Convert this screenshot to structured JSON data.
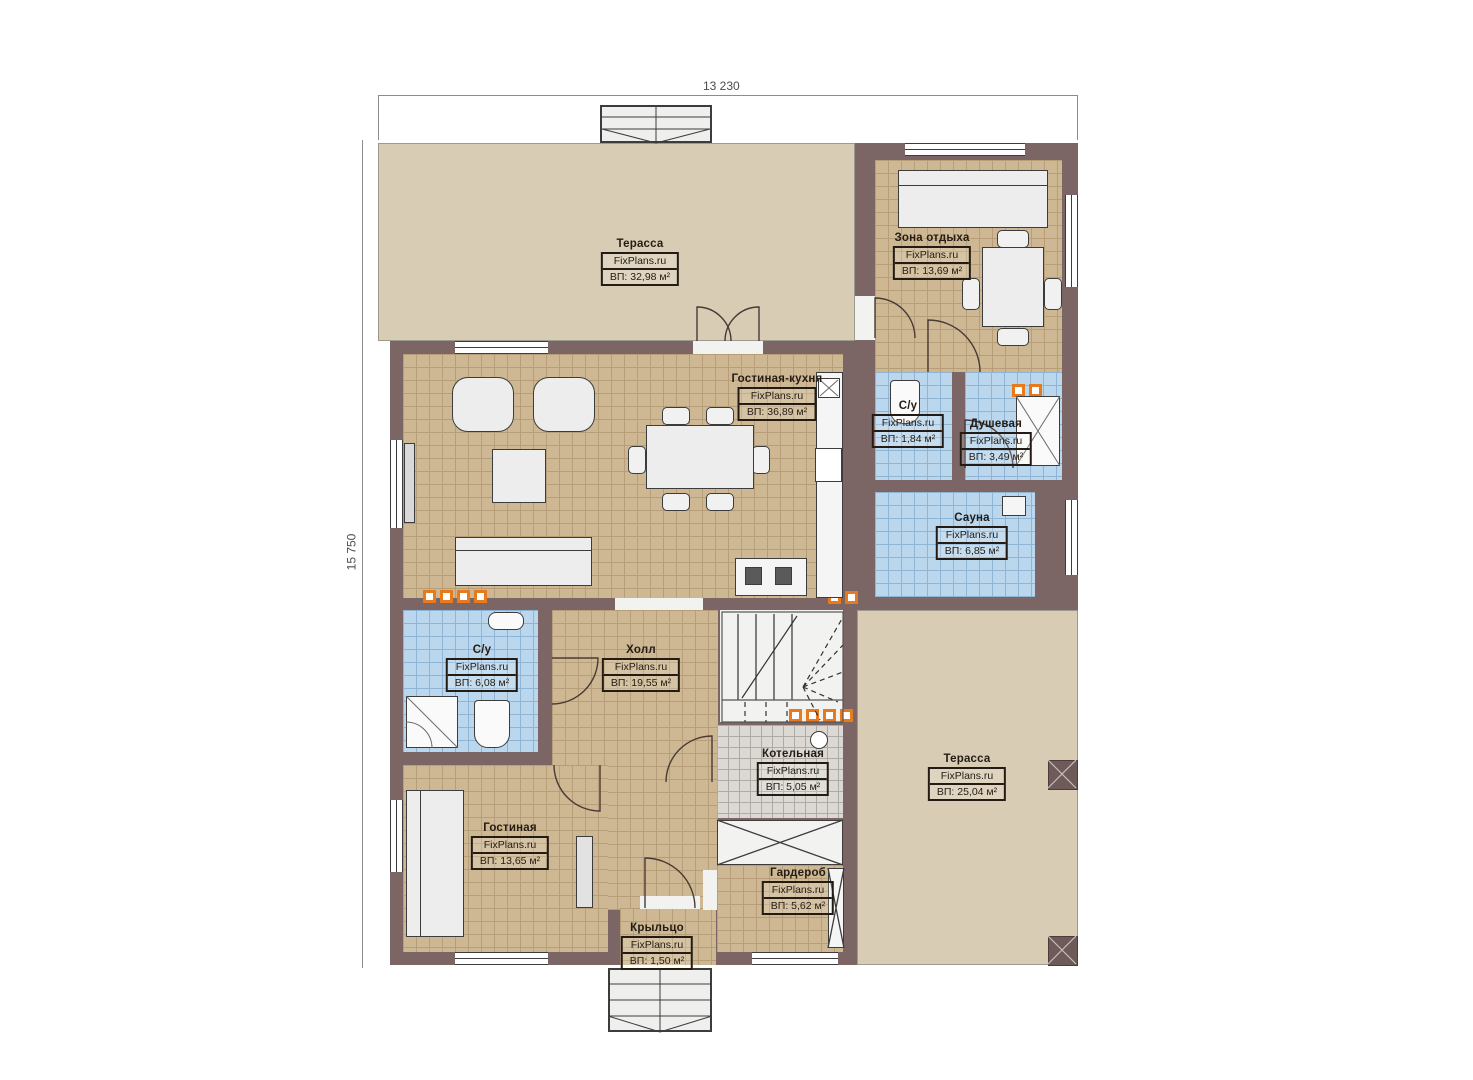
{
  "title": "План первого этажа — FixPlans.ru",
  "brand": "FixPlans.ru",
  "dims": {
    "top": "13 230",
    "left": "15 750"
  },
  "colors": {
    "wall": "#7b6665",
    "floor_tan": "#cdb893",
    "floor_blue": "#bad7ed",
    "floor_gray": "#dcd9d4",
    "terrace": "#d8ccb4",
    "vent_orange": "#e87a1e",
    "label_ink": "#241c14"
  },
  "rooms": [
    {
      "id": "terrace-top",
      "name": "Терасса",
      "brand": "FixPlans.ru",
      "area": "ВП: 32,98 м²"
    },
    {
      "id": "zona-otdyha",
      "name": "Зона отдыха",
      "brand": "FixPlans.ru",
      "area": "ВП: 13,69 м²"
    },
    {
      "id": "gostinaya-kuhnya",
      "name": "Гостиная-кухня",
      "brand": "FixPlans.ru",
      "area": "ВП: 36,89 м²"
    },
    {
      "id": "su-small",
      "name": "С/у",
      "brand": "FixPlans.ru",
      "area": "ВП: 1,84 м²"
    },
    {
      "id": "dushevaya",
      "name": "Душевая",
      "brand": "FixPlans.ru",
      "area": "ВП: 3,49 м²"
    },
    {
      "id": "sauna",
      "name": "Сауна",
      "brand": "FixPlans.ru",
      "area": "ВП: 6,85 м²"
    },
    {
      "id": "su-left",
      "name": "С/у",
      "brand": "FixPlans.ru",
      "area": "ВП: 6,08 м²"
    },
    {
      "id": "holl",
      "name": "Холл",
      "brand": "FixPlans.ru",
      "area": "ВП: 19,55 м²"
    },
    {
      "id": "kotelnaya",
      "name": "Котельная",
      "brand": "FixPlans.ru",
      "area": "ВП: 5,05 м²"
    },
    {
      "id": "terrace-right",
      "name": "Терасса",
      "brand": "FixPlans.ru",
      "area": "ВП: 25,04 м²"
    },
    {
      "id": "gostinaya",
      "name": "Гостиная",
      "brand": "FixPlans.ru",
      "area": "ВП: 13,65 м²"
    },
    {
      "id": "garderob",
      "name": "Гардероб",
      "brand": "FixPlans.ru",
      "area": "ВП: 5,62 м²"
    },
    {
      "id": "krylco",
      "name": "Крыльцо",
      "brand": "FixPlans.ru",
      "area": "ВП: 1,50 м²"
    }
  ]
}
